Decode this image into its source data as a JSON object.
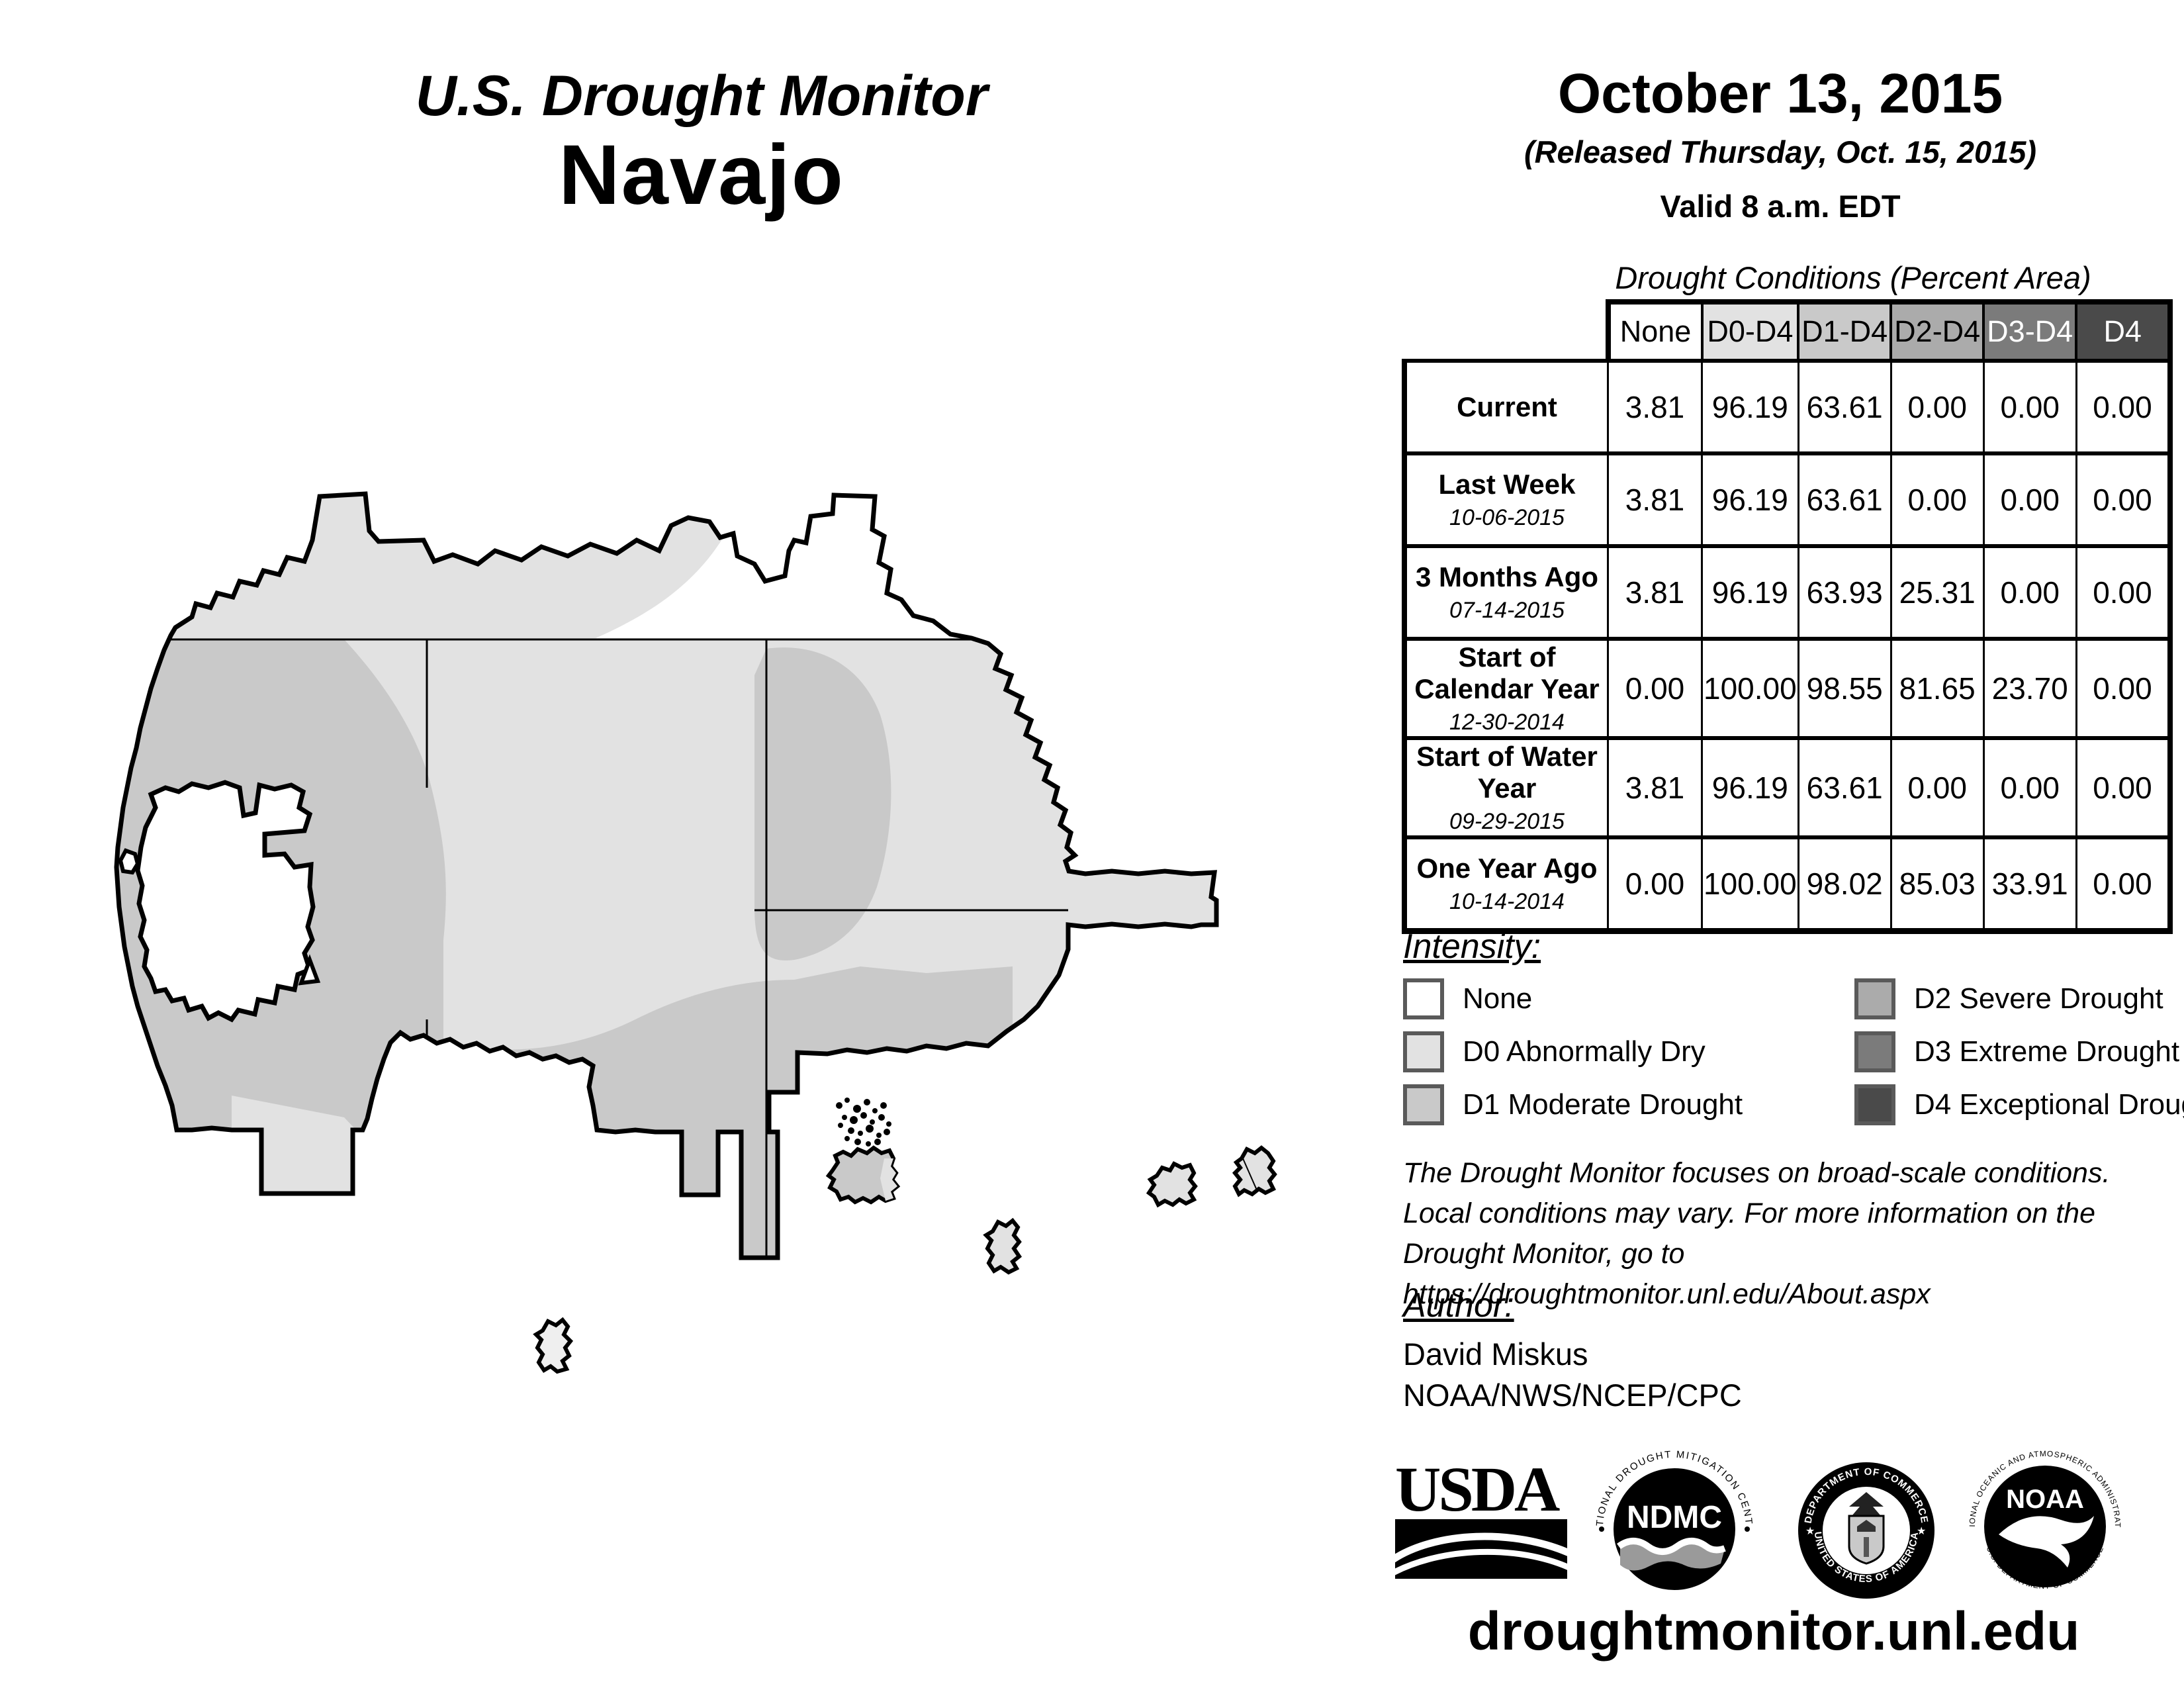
{
  "title": {
    "line1": "U.S. Drought Monitor",
    "line2": "Navajo"
  },
  "date_block": {
    "date": "October 13, 2015",
    "released": "(Released Thursday, Oct. 15, 2015)",
    "valid": "Valid 8 a.m. EDT"
  },
  "table": {
    "caption": "Drought Conditions (Percent Area)",
    "columns": [
      {
        "label": "None",
        "bg": "#ffffff",
        "fg": "#000000"
      },
      {
        "label": "D0-D4",
        "bg": "#e2e2e2",
        "fg": "#000000"
      },
      {
        "label": "D1-D4",
        "bg": "#c9c9c9",
        "fg": "#000000"
      },
      {
        "label": "D2-D4",
        "bg": "#ababab",
        "fg": "#000000"
      },
      {
        "label": "D3-D4",
        "bg": "#7b7b7b",
        "fg": "#ffffff"
      },
      {
        "label": "D4",
        "bg": "#4a4a4a",
        "fg": "#ffffff"
      }
    ],
    "rows": [
      {
        "label": "Current",
        "sub": "",
        "values": [
          "3.81",
          "96.19",
          "63.61",
          "0.00",
          "0.00",
          "0.00"
        ]
      },
      {
        "label": "Last Week",
        "sub": "10-06-2015",
        "values": [
          "3.81",
          "96.19",
          "63.61",
          "0.00",
          "0.00",
          "0.00"
        ]
      },
      {
        "label": "3 Months Ago",
        "sub": "07-14-2015",
        "values": [
          "3.81",
          "96.19",
          "63.93",
          "25.31",
          "0.00",
          "0.00"
        ]
      },
      {
        "label": "Start of Calendar Year",
        "sub": "12-30-2014",
        "values": [
          "0.00",
          "100.00",
          "98.55",
          "81.65",
          "23.70",
          "0.00"
        ]
      },
      {
        "label": "Start of Water Year",
        "sub": "09-29-2015",
        "values": [
          "3.81",
          "96.19",
          "63.61",
          "0.00",
          "0.00",
          "0.00"
        ]
      },
      {
        "label": "One Year Ago",
        "sub": "10-14-2014",
        "values": [
          "0.00",
          "100.00",
          "98.02",
          "85.03",
          "33.91",
          "0.00"
        ]
      }
    ]
  },
  "legend": {
    "heading": "Intensity:",
    "items": [
      {
        "label": "None",
        "color": "#ffffff"
      },
      {
        "label": "D0 Abnormally Dry",
        "color": "#e2e2e2"
      },
      {
        "label": "D1 Moderate Drought",
        "color": "#c9c9c9"
      },
      {
        "label": "D2 Severe Drought",
        "color": "#ababab"
      },
      {
        "label": "D3 Extreme Drought",
        "color": "#7b7b7b"
      },
      {
        "label": "D4 Exceptional Drought",
        "color": "#4a4a4a"
      }
    ]
  },
  "disclaimer": {
    "line1": "The Drought Monitor focuses on broad-scale conditions.",
    "line2": "Local conditions may vary. For more information on the",
    "line3": "Drought Monitor, go to https://droughtmonitor.unl.edu/About.aspx"
  },
  "author": {
    "heading": "Author:",
    "name": "David Miskus",
    "org": "NOAA/NWS/NCEP/CPC"
  },
  "footer": {
    "url": "droughtmonitor.unl.edu"
  },
  "logos": {
    "usda": "USDA",
    "ndmc": {
      "center": "NDMC",
      "ring_top": "NATIONAL DROUGHT MITIGATION CENTER",
      "ring_bottom": "UNIVERSITY OF NEBRASKA"
    },
    "doc": {
      "ring_top": "DEPARTMENT OF COMMERCE",
      "ring_bottom": "UNITED STATES OF AMERICA"
    },
    "noaa": {
      "center": "NOAA",
      "ring_top": "NATIONAL OCEANIC AND ATMOSPHERIC ADMINISTRATION",
      "ring_bottom": "U.S. DEPARTMENT OF COMMERCE"
    }
  },
  "map": {
    "region_label": "Navajo Nation drought map",
    "shading": {
      "none": "#ffffff",
      "d0": "#e2e2e2",
      "d1": "#c9c9c9"
    }
  }
}
